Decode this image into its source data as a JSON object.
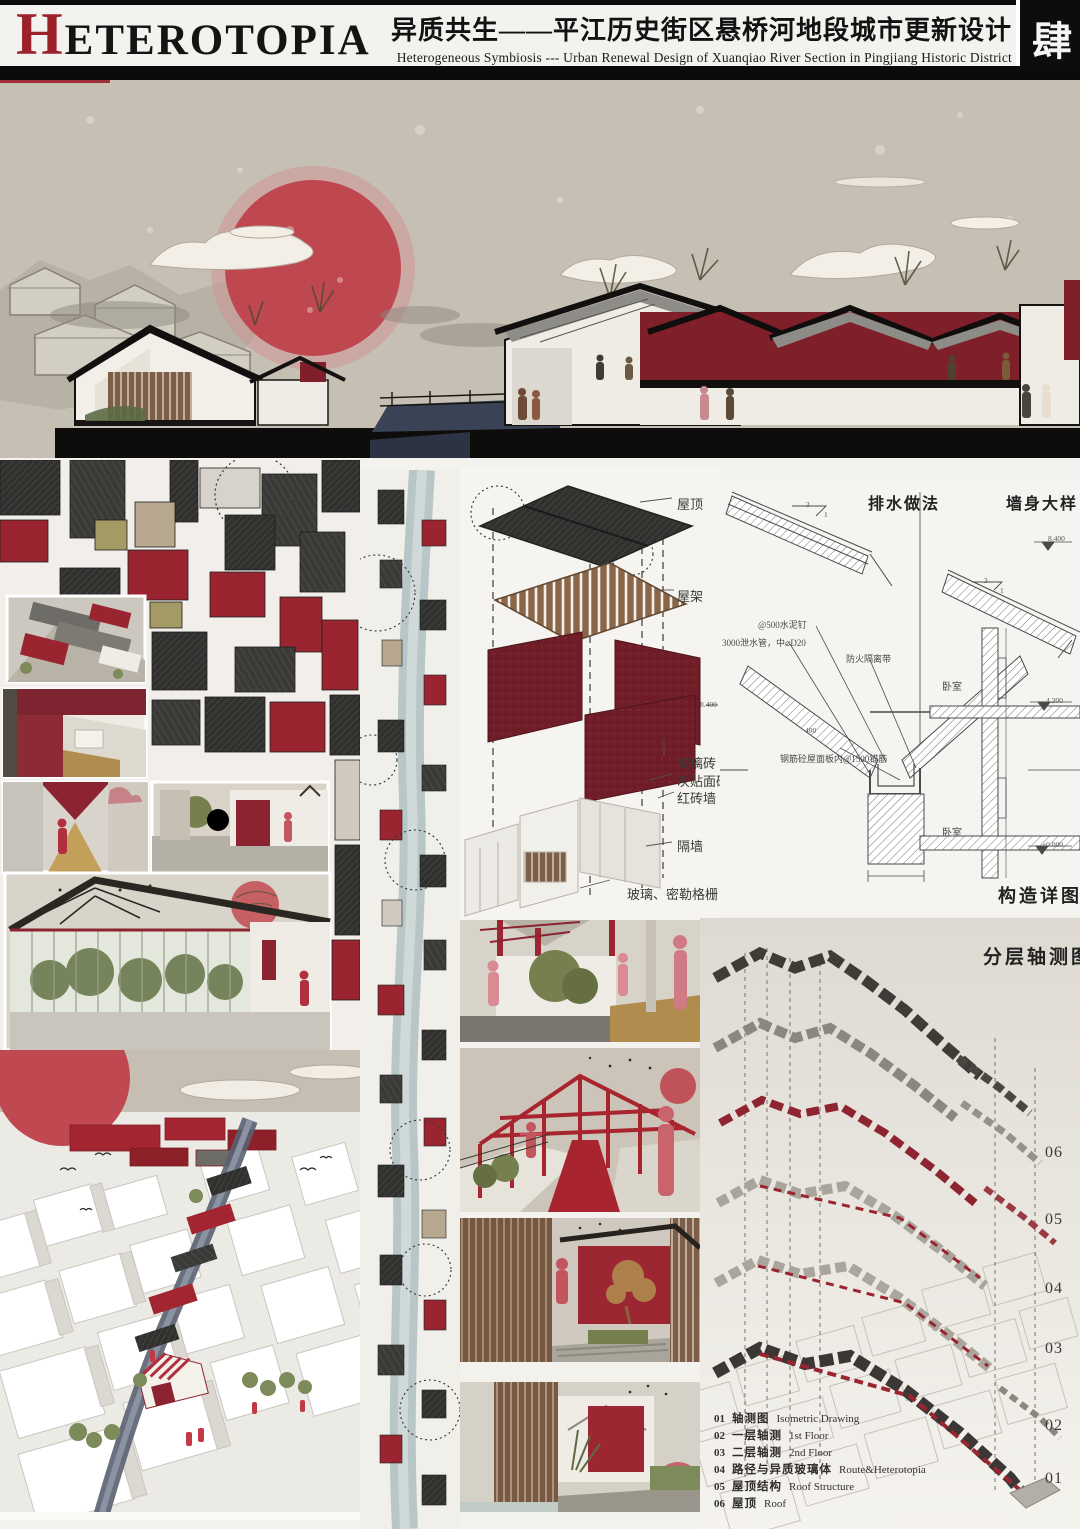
{
  "header": {
    "logo_initial": "H",
    "logo_rest": "ETEROTOPIA",
    "title_cn": "异质共生——平江历史街区悬桥河地段城市更新设计",
    "title_en": "Heterogeneous Symbiosis --- Urban Renewal Design of Xuanqiao River Section in Pingjiang Historic District",
    "page_badge": "肆"
  },
  "exploded": {
    "labels": [
      "屋顶",
      "屋架",
      "玻璃砖",
      "灰贴面砖",
      "红砖墙",
      "隔墙"
    ],
    "bottom_label": "玻璃、密勒格栅",
    "elevation": "8.400"
  },
  "construction": {
    "drainage_title": "排水做法",
    "wall_title": "墙身大样",
    "caption": "构造详图",
    "slope_num": "3",
    "slope_den": "1",
    "dim_400": "400",
    "ann": {
      "cement_nail": "@500水泥钉",
      "drain_pipe": "3000泄水管，中⌀D20",
      "fire_belt": "防火隔离带",
      "anchor": "钢筋砼屋面板内@1500锚筋"
    },
    "rooms": [
      "卧室",
      "卧室"
    ],
    "elevations": [
      "8.400",
      "4.200",
      "±0.000"
    ]
  },
  "layered": {
    "title": "分层轴测图",
    "numbers": [
      "06",
      "05",
      "04",
      "03",
      "02",
      "01"
    ],
    "legend": [
      {
        "num": "01",
        "cn": "轴测图",
        "en": "Isometric Drawing"
      },
      {
        "num": "02",
        "cn": "一层轴测",
        "en": "1st Floor"
      },
      {
        "num": "03",
        "cn": "二层轴测",
        "en": "2nd Floor"
      },
      {
        "num": "04",
        "cn": "路径与异质玻璃体",
        "en": "Route&Heterotopia"
      },
      {
        "num": "05",
        "cn": "屋顶结构",
        "en": "Roof Structure"
      },
      {
        "num": "06",
        "cn": "屋顶",
        "en": "Roof"
      }
    ]
  },
  "colors": {
    "accent_red": "#9a2531",
    "maroon_wall": "#7a1f2a",
    "sun_red": "#bf4850",
    "roof_dark": "#30302e",
    "sky_taupe": "#c2bab0",
    "water": "#b9c6c7",
    "wood": "#8a5b3b"
  }
}
